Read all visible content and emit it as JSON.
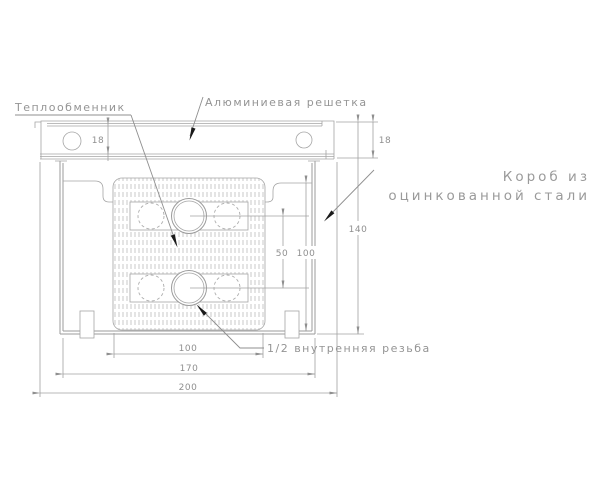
{
  "drawing": {
    "title": "Convector cross-section technical drawing",
    "labels": {
      "heat_exchanger": "Теплообменник",
      "aluminum_grille": "Алюминиевая решетка",
      "steel_box_line1": "Короб из",
      "steel_box_line2": "оцинкованной стали",
      "thread": "1/2 внутренняя резьба"
    },
    "dimensions": {
      "grille_height_left": "18",
      "grille_height_right": "18",
      "overall_height": "140",
      "inner_height": "100",
      "pipe_center_spacing": "50",
      "exchanger_width": "100",
      "box_width": "170",
      "overall_width": "200"
    },
    "colors": {
      "line": "#9b9b9b",
      "hatch": "#bdbdbd",
      "text": "#8f8f8f",
      "leader_arrow": "#1a1a1a",
      "background": "#ffffff"
    }
  }
}
